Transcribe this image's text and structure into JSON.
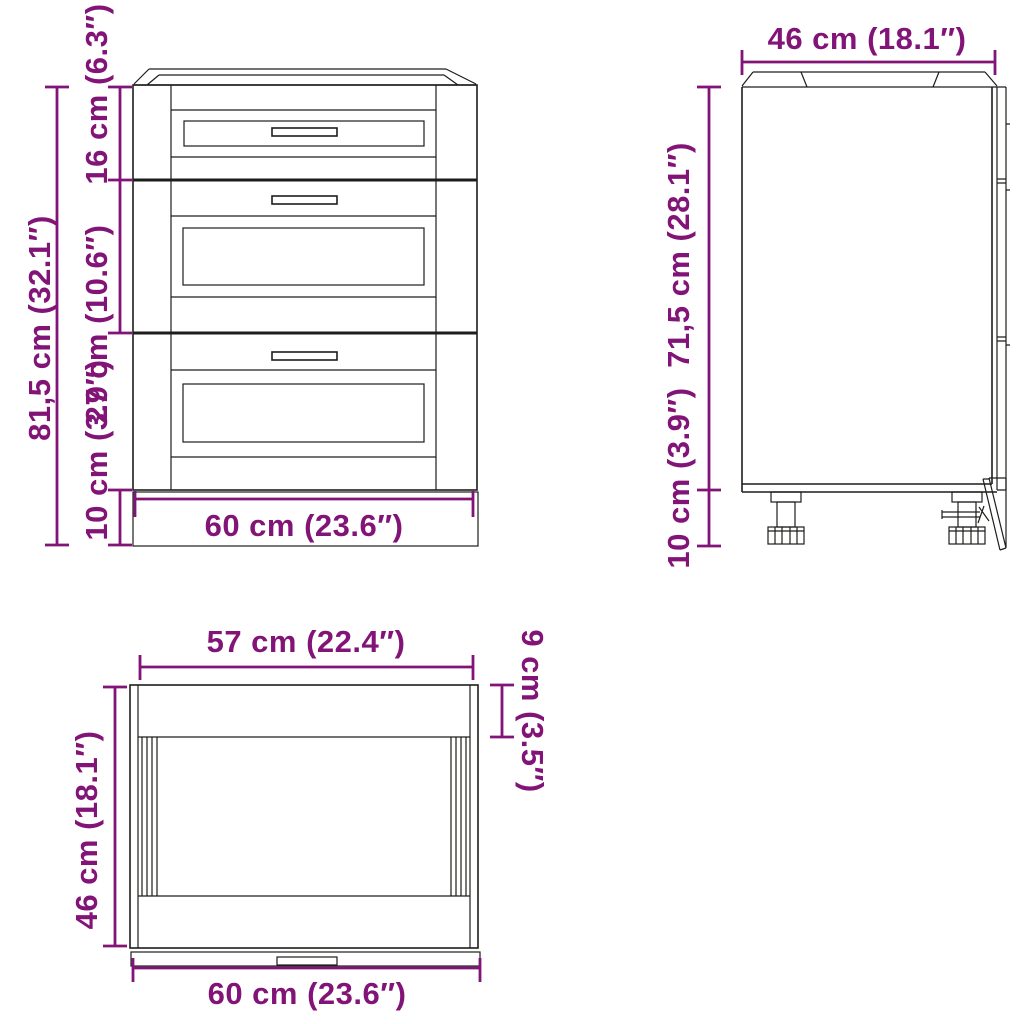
{
  "image_type": "furniture-dimension-diagram",
  "product": "kitchen base cabinet with 3 drawers",
  "colors": {
    "dimension_purple": "#821478",
    "line_black": "#1d1d1b",
    "background": "#ffffff"
  },
  "views": {
    "front": {
      "name": "front view",
      "dimensions": {
        "total_height": "81,5 cm (32.1″)",
        "top_drawer": "16 cm (6.3″)",
        "middle_drawer": "27 cm (10.6″)",
        "plinth": "10 cm (3.9″)",
        "width": "60 cm (23.6″)"
      }
    },
    "side": {
      "name": "side view",
      "dimensions": {
        "depth": "46 cm (18.1″)",
        "body_height": "71,5 cm (28.1″)",
        "plinth": "10 cm (3.9″)"
      }
    },
    "top": {
      "name": "top view",
      "dimensions": {
        "front_width": "57 cm (22.4″)",
        "top_depth": "9 cm (3.5″)",
        "depth": "46 cm (18.1″)",
        "width": "60 cm (23.6″)"
      }
    }
  }
}
